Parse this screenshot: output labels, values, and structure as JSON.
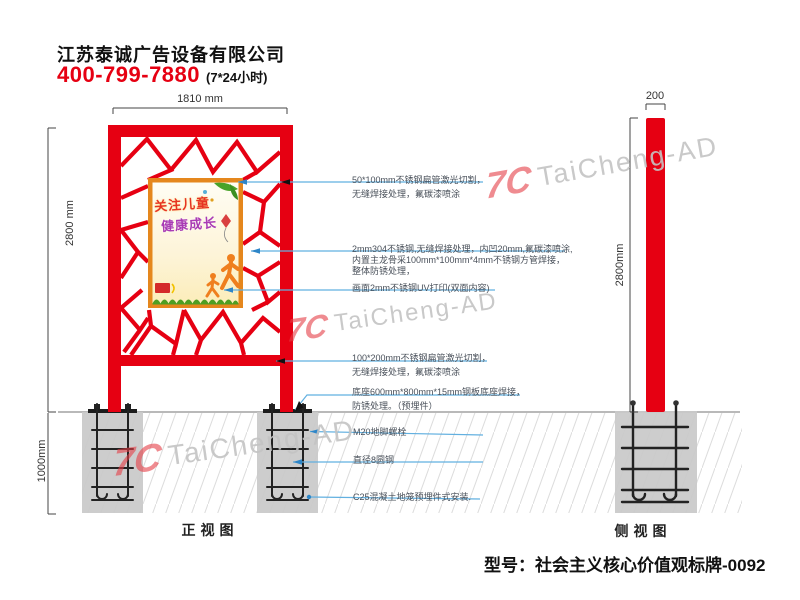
{
  "header": {
    "company": "江苏泰诚广告设备有限公司",
    "phone": "400-799-7880",
    "hours": "(7*24小时)"
  },
  "front_view": {
    "label": "正视图",
    "dim_width": "1810 mm",
    "dim_height": "2800 mm",
    "dim_foundation_depth": "1000mm",
    "poster": {
      "line1": "关注儿童",
      "line2": "健康成长"
    }
  },
  "side_view": {
    "label": "侧视图",
    "dim_width": "200",
    "dim_height": "2800mm"
  },
  "annotations": [
    {
      "lines": [
        "50*100mm不锈钢扁管激光切割，",
        "无缝焊接处理，氟碳漆喷涂"
      ]
    },
    {
      "lines": [
        "2mm304不锈钢,无缝焊接处理，内凹20mm,氟碳漆喷涂,",
        "内置主龙骨采100mm*100mm*4mm不锈钢方管焊接，",
        "整体防锈处理，"
      ]
    },
    {
      "lines": [
        "画面2mm不锈钢UV打印(双面内容)"
      ]
    },
    {
      "lines": [
        "100*200mm不锈钢扁管激光切割，",
        "无缝焊接处理，氟碳漆喷涂"
      ]
    },
    {
      "lines": [
        "底座600mm*800mm*15mm钢板底座焊接，",
        "防锈处理。（预埋件）"
      ]
    },
    {
      "lines": [
        "M20地脚螺栓"
      ]
    },
    {
      "lines": [
        "直径8圆钢"
      ]
    },
    {
      "lines": [
        "C25混凝土地笼预埋件式安装."
      ]
    }
  ],
  "watermark": {
    "logo": "7C",
    "text": "TaiCheng-AD"
  },
  "footer": {
    "model": "型号：社会主义核心价值观标牌-0092"
  },
  "colors": {
    "structure_red": "#e60012",
    "poster_frame_orange": "#e5871d",
    "concrete_gray": "#c9c9c9",
    "leader_blue": "#62b0e0",
    "phone_red": "#e60012",
    "watermark_gray": "#c3c3c3"
  }
}
